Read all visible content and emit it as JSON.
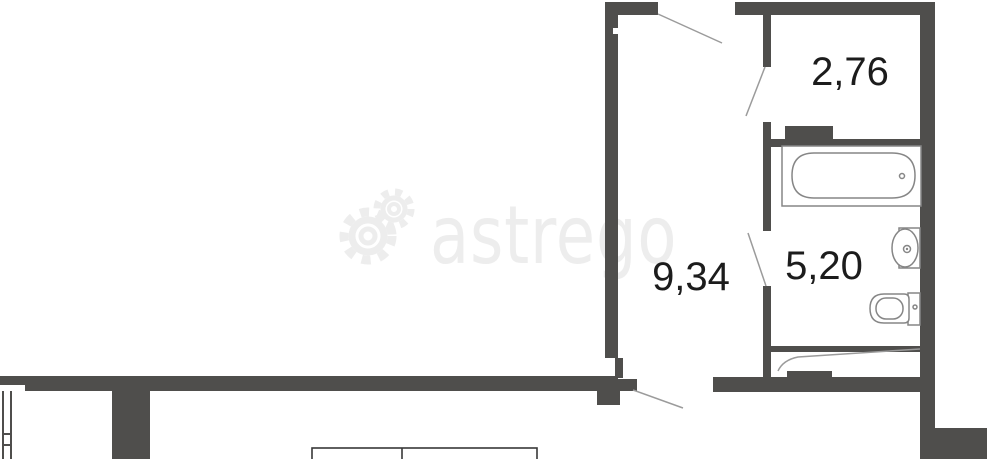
{
  "watermark": {
    "brand": "astrego"
  },
  "labels": {
    "room_top_right": "2,76",
    "hall": "9,34",
    "bathroom": "5,20"
  },
  "colors": {
    "wall": "#4f4e4c",
    "label_text": "#1c1c1c",
    "door_line": "#9b9b9b",
    "fixture_stroke": "#868686",
    "watermark": "#ededed",
    "background": "#ffffff"
  }
}
